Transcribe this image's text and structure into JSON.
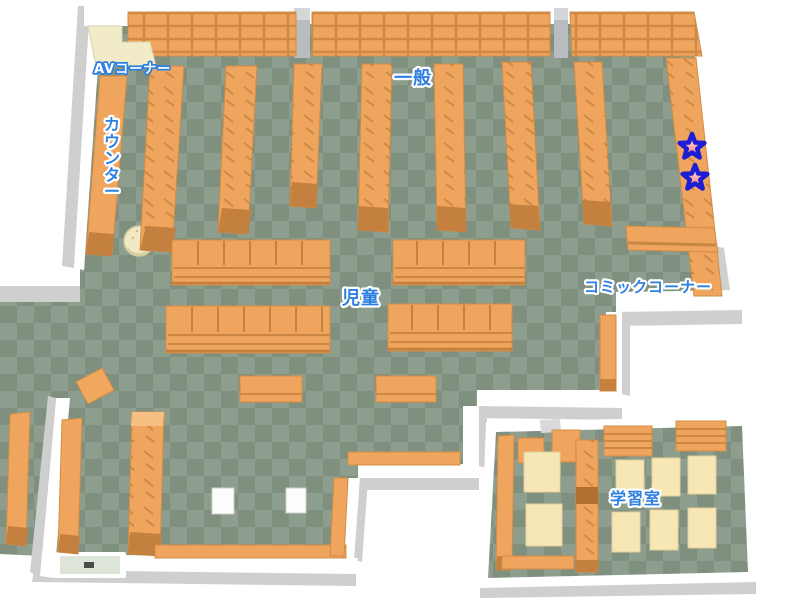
{
  "map": {
    "areas": {
      "av_corner": {
        "label": "AVコーナー"
      },
      "counter": {
        "label": "カウンター"
      },
      "general": {
        "label": "一般"
      },
      "children": {
        "label": "児童"
      },
      "comic_corner": {
        "label": "コミックコーナー"
      },
      "study_room": {
        "label": "学習室"
      }
    },
    "markers": {
      "star_count": 2,
      "stars": [
        {
          "x": 692,
          "y": 147
        },
        {
          "x": 695,
          "y": 178
        }
      ]
    },
    "colors": {
      "floor_light": "#8e9e8e",
      "floor_dark": "#7f907f",
      "shelf_orange": "#efa55d",
      "shelf_end": "#c4803e",
      "wall_white": "#ffffff",
      "wall_shadow": "#cfcfcf",
      "desk_cream": "#f7e7b4",
      "counter_cream": "#f2ebc8",
      "label_blue": "#2e7fe2",
      "star_red": "#ef5d5d",
      "star_outline_blue": "#1d1dd6"
    }
  }
}
